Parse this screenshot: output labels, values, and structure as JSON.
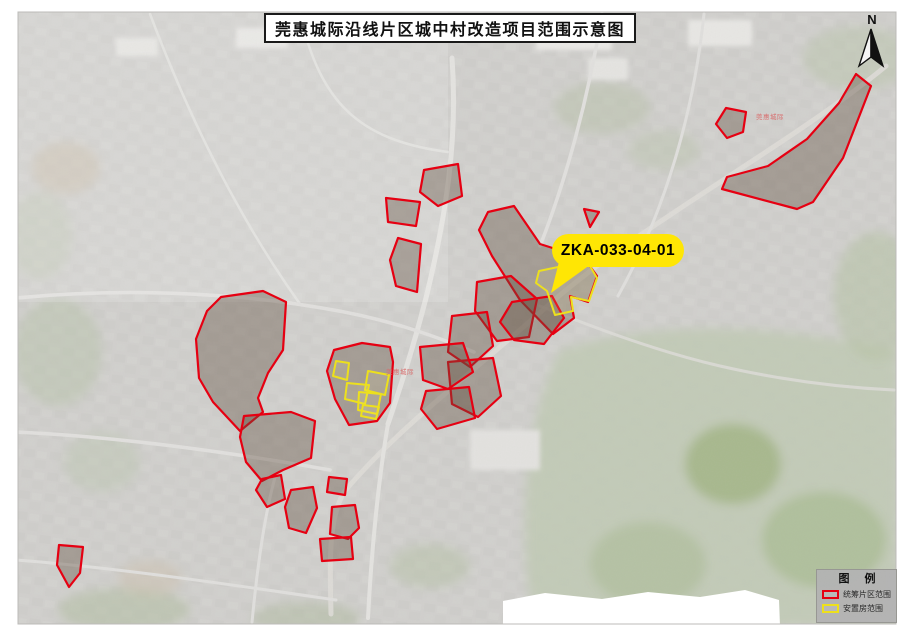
{
  "map": {
    "title": "莞惠城际沿线片区城中村改造项目范围示意图",
    "callout": {
      "label": "ZKA-033-04-01"
    },
    "north_arrow_label": "N",
    "legend": {
      "title": "图 例",
      "items": [
        {
          "label": "统筹片区范围",
          "swatch_color": "#e60012"
        },
        {
          "label": "安置房范围",
          "swatch_color": "#ede01c"
        }
      ]
    },
    "small_labels": [
      {
        "text": "莞惠城际",
        "x": 756,
        "y": 114
      },
      {
        "text": "莞惠城际",
        "x": 386,
        "y": 369
      }
    ],
    "colors": {
      "project_area_outline": "#e60012",
      "resettlement_outline": "#ede01c",
      "callout_bg": "#ffe604",
      "label_red": "#d96a6a"
    },
    "overlays": {
      "red_polygons": [
        "424,170 458,164 462,196 438,206 420,192",
        "386,198 420,202 416,226 388,222",
        "398,238 421,244 417,292 396,286 390,260",
        "726,108 746,112 743,132 727,138 716,124",
        "856,74 871,86 843,158 813,202 797,209 722,189 727,177 768,166 807,139 839,103",
        "488,212 514,206 540,244 584,258 597,276 588,302 570,296 574,318 553,334 520,300 492,256 479,230",
        "477,282 511,276 537,299 529,337 497,341 475,311",
        "584,209 599,212 590,227",
        "221,297 263,291 286,302 283,350 268,373 258,398 263,412 240,431 213,402 199,378 196,339 207,311",
        "334,350 362,343 390,347 393,362 390,403 377,421 349,425 335,399 327,371",
        "512,302 552,296 564,318 544,344 514,340 500,322",
        "452,316 487,312 493,346 470,367 448,352",
        "448,362 493,358 501,396 478,417 452,404",
        "420,347 463,343 473,372 448,389 423,380",
        "426,391 469,387 475,418 437,429 421,409",
        "244,416 291,412 315,421 311,458 283,470 262,481 246,462 240,437",
        "262,479 281,475 285,499 267,507 256,490",
        "329,477 347,479 345,495 327,492",
        "291,490 313,487 317,508 306,533 289,528 285,507",
        "332,507 355,505 359,528 348,539 330,534",
        "320,539 351,537 353,559 322,561",
        "59,545 83,547 80,573 69,587 57,565"
      ],
      "yellow_polygons": [
        "539,271 587,261 597,278 589,301 571,297 573,311 555,315 547,291 536,283",
        "336,361 349,363 347,380 333,376",
        "368,371 389,375 385,395 365,390",
        "347,383 369,385 365,404 345,399",
        "359,392 381,394 377,414 358,410",
        "363,405 379,407 376,419 361,416"
      ]
    }
  }
}
